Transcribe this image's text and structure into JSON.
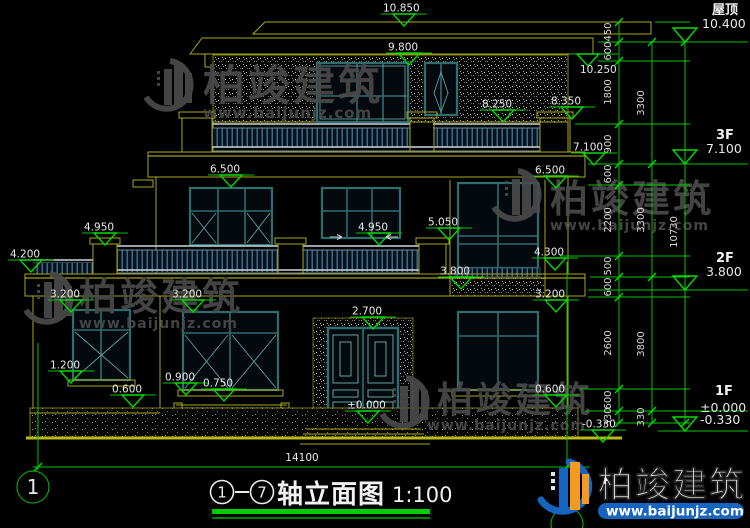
{
  "doc": {
    "title": {
      "axis_from": "1",
      "axis_to": "7",
      "name": "轴立面图",
      "scale": "1:100"
    },
    "bottom_dim": "14100",
    "axis_bubble": "1"
  },
  "right_panel": {
    "floors": [
      {
        "label": "屋顶",
        "elev": "10.400"
      },
      {
        "label": "3F",
        "elev": "7.100"
      },
      {
        "label": "2F",
        "elev": "3.800"
      },
      {
        "label": "1F",
        "elev": "±0.000",
        "elev_sub": "-0.330"
      }
    ],
    "chain_inner": [
      "450",
      "600",
      "1800",
      "900",
      "600",
      "2200",
      "500",
      "600",
      "2600",
      "600",
      "330"
    ],
    "chain_mid": [
      "3300",
      "3300",
      "3800",
      "330"
    ],
    "chain_outer": [
      "10730"
    ]
  },
  "levels": [
    {
      "v": "10.850"
    },
    {
      "v": "9.800"
    },
    {
      "v": "10.250"
    },
    {
      "v": "8.250"
    },
    {
      "v": "8.350"
    },
    {
      "v": "7.100"
    },
    {
      "v": "6.500"
    },
    {
      "v": "6.500"
    },
    {
      "v": "4.950"
    },
    {
      "v": "4.950"
    },
    {
      "v": "5.050"
    },
    {
      "v": "4.200"
    },
    {
      "v": "3.800"
    },
    {
      "v": "4.300"
    },
    {
      "v": "3.200"
    },
    {
      "v": "3.200"
    },
    {
      "v": "3.200"
    },
    {
      "v": "2.700"
    },
    {
      "v": "1.200"
    },
    {
      "v": "0.900"
    },
    {
      "v": "0.750"
    },
    {
      "v": "0.600"
    },
    {
      "v": "0.600"
    },
    {
      "v": "±0.000"
    },
    {
      "v": "-0.330"
    }
  ],
  "watermark": {
    "brand": "柏竣建筑",
    "url": "www.baijunjz.com"
  },
  "logo": {
    "brand": "柏竣建筑",
    "url": "www.baijunjz.com"
  },
  "colors": {
    "background": "#000000",
    "line_yellow": "#a8a81e",
    "dim_green": "#00c400",
    "frame_teal": "#2e6e6e",
    "rail_blue": "#4a7fa2",
    "text_white": "#e8e8e8",
    "logo_blue": "#1565c0",
    "logo_orange": "#f59a23",
    "watermark_gray": "#4a4a4a"
  }
}
